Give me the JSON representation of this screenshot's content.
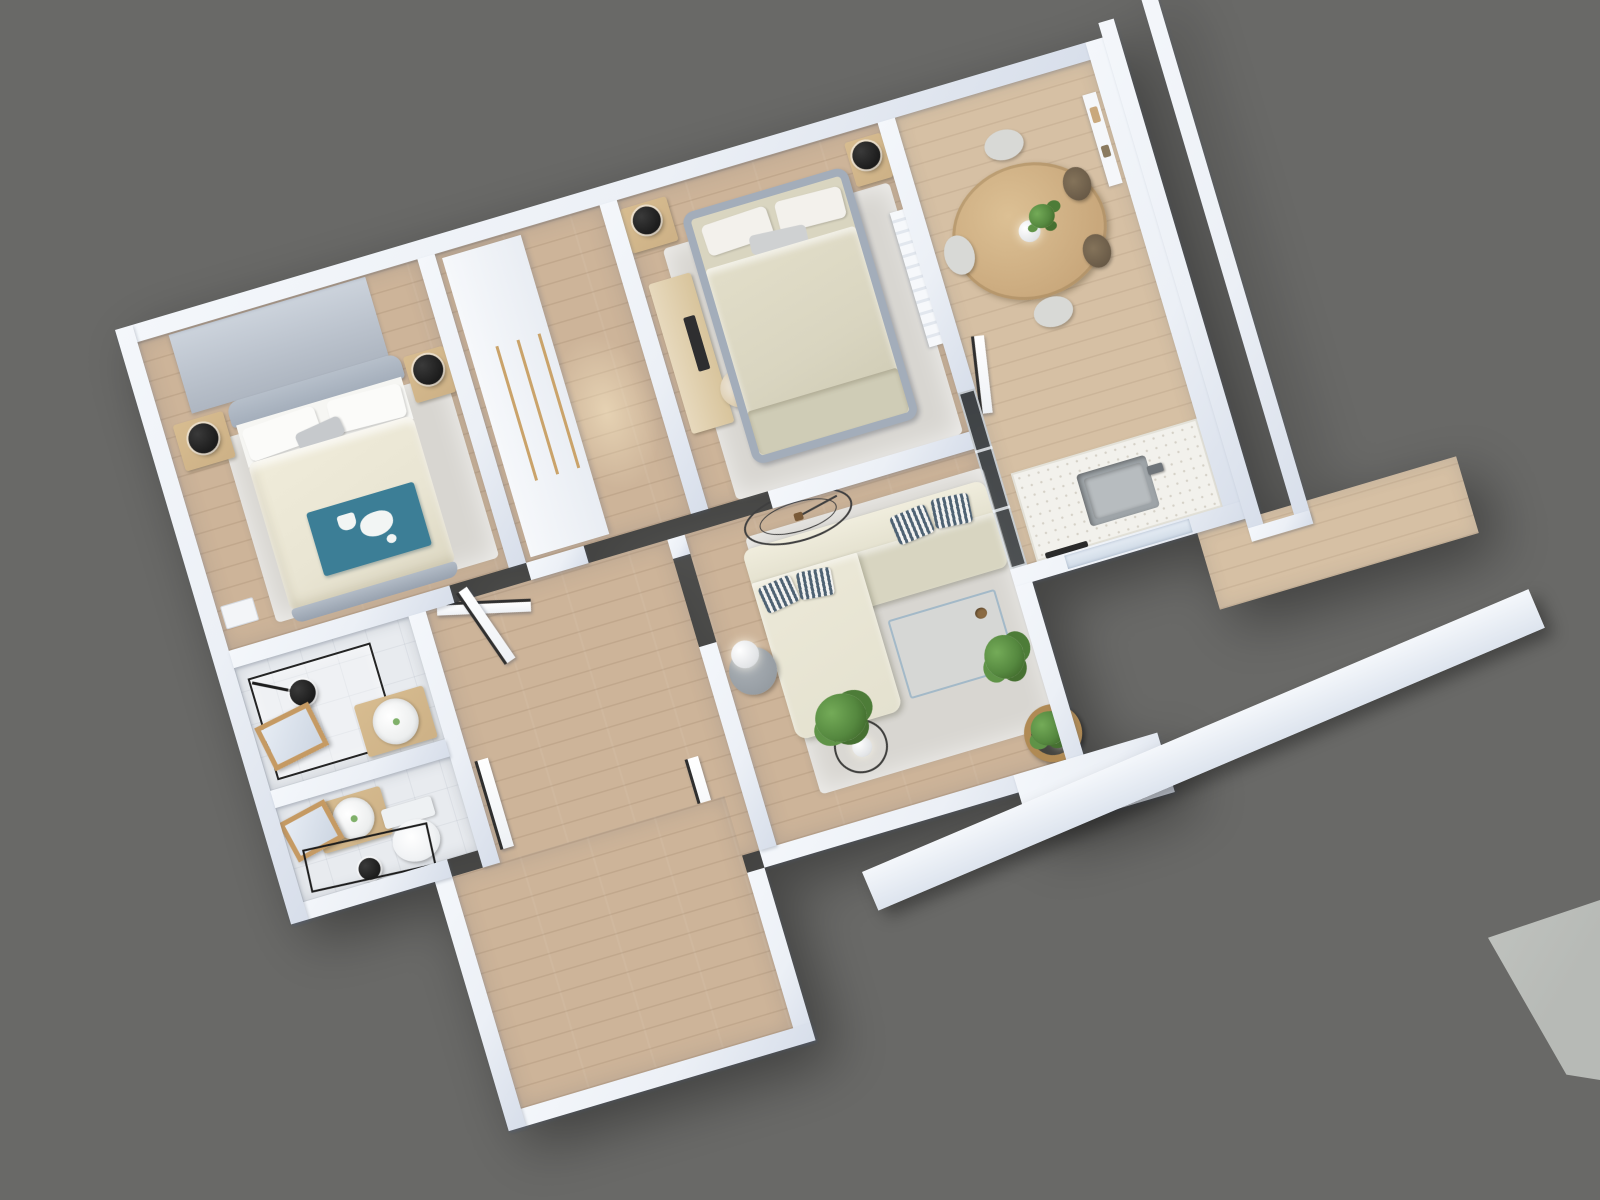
{
  "scene": {
    "type": "3d-floorplan-dollhouse-render",
    "view": "top-down axonometric, plan rotated about -16.5 degrees",
    "background_color": "#696967",
    "corner_slab_color": "#b7bab6",
    "no_visible_text": true
  },
  "palette": {
    "wall": "#ecf0f6",
    "wall_shade": "#d7deea",
    "wood_floor": "#cdb499",
    "wood_light": "#d6c0a4",
    "tile": "#e8ebef",
    "rug": "#d8d6d1",
    "wood_furniture": "#cdb186",
    "sofa": "#e4e1cf",
    "duvet_master": "#e9e5d3",
    "duvet_guest": "#d9d5c0",
    "teal_blanket": "#3c7e96",
    "bed_frame_gray": "#a3adba",
    "black_accent": "#1c1c1c",
    "plant_green": "#55883f",
    "marble_counter": "#f2f1ec"
  },
  "rooms": [
    {
      "id": "master-bedroom",
      "area": "top-left",
      "objects": [
        "roller-blind-window",
        "double-bed",
        "white-pillows",
        "gray-pillow",
        "cream-duvet",
        "teal-blanket-with-cat-motif",
        "nightstand-left",
        "nightstand-right",
        "black-sphere-lamp-x2",
        "area-rug",
        "wall-tray"
      ]
    },
    {
      "id": "walk-in-closet",
      "area": "top-center",
      "objects": [
        "white-wardrobe-with-wood-handles",
        "wood-floor"
      ]
    },
    {
      "id": "bedroom-2",
      "area": "top-right",
      "objects": [
        "gray-frame-double-bed",
        "beige-duvet",
        "pillows",
        "desk-with-keyboard",
        "desk-chair",
        "nightstand-left",
        "nightstand-right",
        "black-sphere-lamp-x2",
        "area-rug",
        "radiator-panel"
      ]
    },
    {
      "id": "bathroom-shower",
      "area": "mid-left",
      "objects": [
        "black-frame-glass-shower",
        "ceiling-arm-lamp",
        "wood-vanity",
        "round-basin",
        "wood-frame-mirror"
      ]
    },
    {
      "id": "wc",
      "area": "lower-left",
      "objects": [
        "toilet",
        "wood-vanity",
        "round-basin",
        "wood-frame-mirror",
        "black-towel-frame",
        "black-ceiling-lamp"
      ]
    },
    {
      "id": "living-room",
      "area": "center",
      "objects": [
        "l-shaped-cream-sectional-sofa",
        "striped-pillows-x4",
        "wall-clock-ellipse",
        "side-table",
        "white-sphere-lamp",
        "glass-coffee-table",
        "fluffy-rug",
        "wire-stand-plant",
        "tall-plant",
        "round-wood-planter-with-lamp"
      ]
    },
    {
      "id": "kitchen-dining",
      "area": "right",
      "objects": [
        "round-wood-dining-table",
        "pendant-lamp",
        "table-plant",
        "chairs-light-x3",
        "chairs-dark-wicker-x2",
        "kitchen-counter",
        "marble-countertop",
        "sink-with-faucet",
        "dishwasher-handle",
        "wall-shelf",
        "window",
        "door-leaf"
      ]
    },
    {
      "id": "hallway",
      "area": "center-left",
      "objects": [
        "wood-floor",
        "door-leaf-bathroom",
        "door-leaf-wc",
        "door-leaf-living",
        "door-leaf-master"
      ]
    },
    {
      "id": "entry-hall",
      "area": "bottom-left",
      "objects": [
        "wood-floor"
      ]
    }
  ],
  "exterior": {
    "glass_partition": "dark sliding glass panels between living room and kitchen",
    "balcony_east": [
      "inner-parapet-strip",
      "outer-parapet-strip",
      "corner-join"
    ],
    "balcony_south": [
      "long-parapet-band",
      "wood-deck"
    ],
    "bottom_right_corner": "light gray neighboring slab polygon"
  }
}
